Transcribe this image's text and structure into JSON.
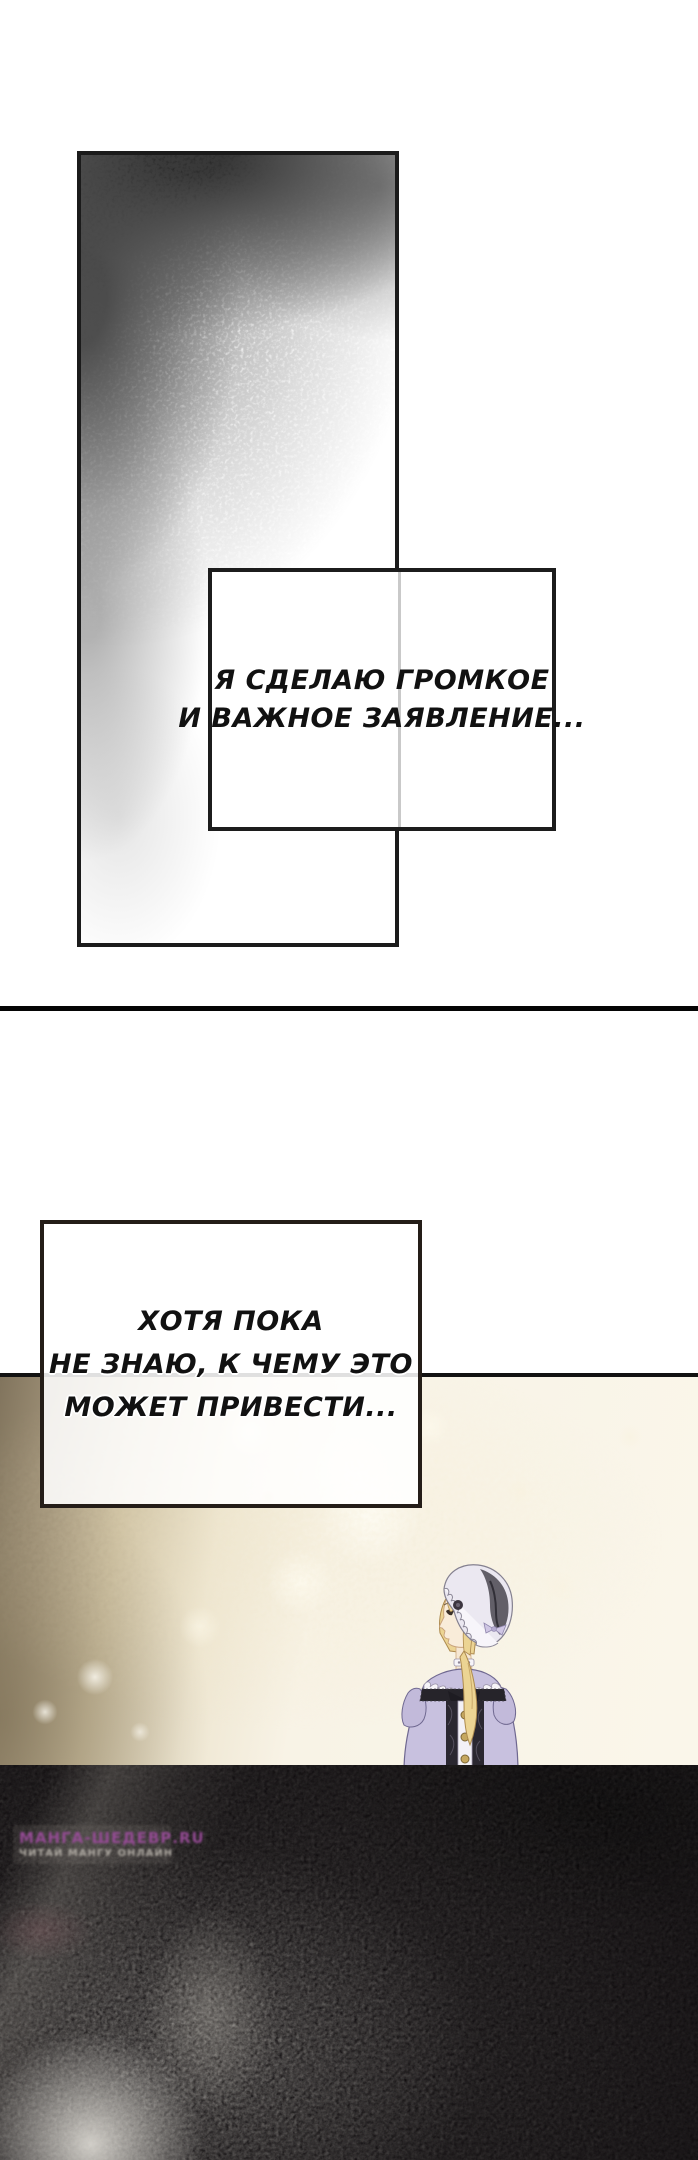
{
  "page": {
    "type": "manhwa-page",
    "background": "#ffffff"
  },
  "speech1": {
    "lines": [
      "Я СДЕЛАЮ ГРОМКОЕ",
      "И ВАЖНОЕ ЗАЯВЛЕНИЕ..."
    ]
  },
  "speech2": {
    "lines": [
      "ХОТЯ ПОКА",
      "НЕ ЗНАЮ, К ЧЕМУ ЭТО",
      "МОЖЕТ ПРИВЕСТИ..."
    ]
  },
  "watermark": {
    "line1": "МАНГА-ШЕДЕВР.RU",
    "line2": "ЧИТАЙ МАНГУ ОНЛАЙН"
  },
  "colors": {
    "panel_border": "#1b1b1b",
    "divider": "#050505",
    "scene_gold": "#f8f3e6",
    "scene_shadow": "#81745d",
    "dark_panel": "#0c090b",
    "watermark_purple": "#9b4d9b",
    "dress_lavender": "#c8c1df",
    "hair_blonde": "#ecd493"
  },
  "scene": {
    "character": "blonde-woman-back-view-lavender-dress-bonnet"
  }
}
